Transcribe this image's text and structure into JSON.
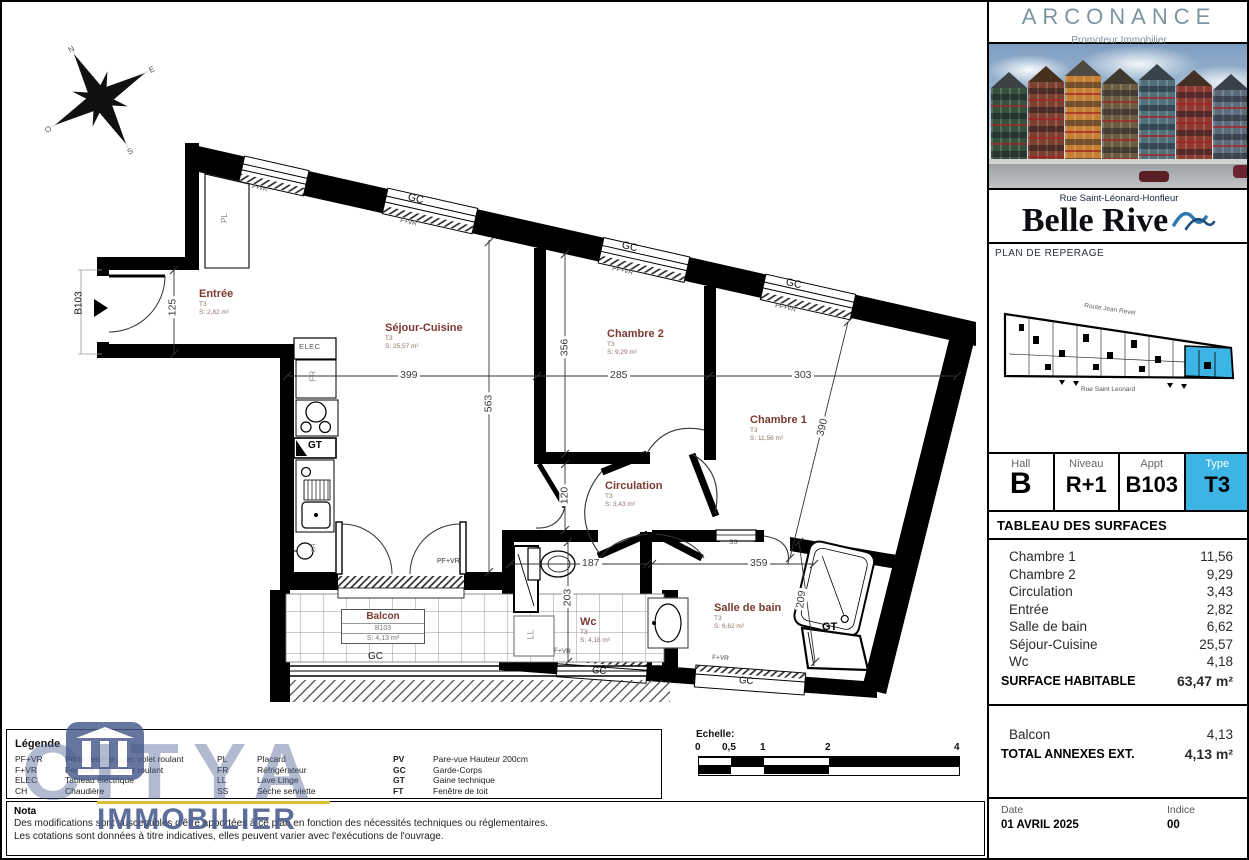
{
  "colors": {
    "accent": "#3cb4e5",
    "room_label": "#7b3a31",
    "brand": "#7b94a1",
    "watermark": "#485a8c"
  },
  "sidebar": {
    "brand": {
      "name": "ARCONANCE",
      "tagline": "Promoteur Immobilier"
    },
    "project": {
      "street": "Rue Saint-Léonard-Honfleur",
      "name": "Belle Rive"
    },
    "reperage": {
      "title": "PLAN DE REPERAGE",
      "street_top": "Route Jean Revel",
      "street_bottom": "Rue Saint Leonard"
    },
    "unit": {
      "hall_label": "Hall",
      "hall_value": "B",
      "niveau_label": "Niveau",
      "niveau_value": "R+1",
      "appt_label": "Appt",
      "appt_value": "B103",
      "type_label": "Type",
      "type_value": "T3"
    },
    "surfaces": {
      "title": "TABLEAU DES SURFACES",
      "rows": [
        {
          "label": "Chambre 1",
          "value": "11,56"
        },
        {
          "label": "Chambre 2",
          "value": "9,29"
        },
        {
          "label": "Circulation",
          "value": "3,43"
        },
        {
          "label": "Entrée",
          "value": "2,82"
        },
        {
          "label": "Salle de bain",
          "value": "6,62"
        },
        {
          "label": "Séjour-Cuisine",
          "value": "25,57"
        },
        {
          "label": "Wc",
          "value": "4,18"
        }
      ],
      "total_label": "SURFACE HABITABLE",
      "total_value": "63,47 m²",
      "annex_rows": [
        {
          "label": "Balcon",
          "value": "4,13"
        }
      ],
      "annex_total_label": "TOTAL ANNEXES EXT.",
      "annex_total_value": "4,13 m²"
    },
    "meta": {
      "date_label": "Date",
      "date_value": "01 AVRIL 2025",
      "indice_label": "Indice",
      "indice_value": "00"
    }
  },
  "plan": {
    "entry_ref": "B103",
    "rooms": {
      "entree": {
        "name": "Entrée",
        "type": "T3",
        "area": "S: 2,82 m²"
      },
      "sejour": {
        "name": "Séjour-Cuisine",
        "type": "T3",
        "area": "S: 25,57 m²"
      },
      "chambre2": {
        "name": "Chambre 2",
        "type": "T3",
        "area": "S: 9,29 m²"
      },
      "chambre1": {
        "name": "Chambre 1",
        "type": "T3",
        "area": "S: 11,56 m²"
      },
      "circulation": {
        "name": "Circulation",
        "type": "T3",
        "area": "S: 3,43 m²"
      },
      "wc": {
        "name": "Wc",
        "type": "T3",
        "area": "S: 4,18 m²"
      },
      "sdb": {
        "name": "Salle de bain",
        "type": "T3",
        "area": "S: 6,62 m²"
      },
      "balcon": {
        "name": "Balcon",
        "ref": "B103",
        "area": "S: 4,13 m²"
      }
    },
    "dims": {
      "d125": "125",
      "d399": "399",
      "d563": "563",
      "d356": "356",
      "d285": "285",
      "d303": "303",
      "d390": "390",
      "d120": "120",
      "d187": "187",
      "d203": "203",
      "d359": "359",
      "d209": "209"
    },
    "labels": {
      "gc": "GC",
      "pfvr": "PF+VR",
      "fvr": "F+VR",
      "elec": "ELEC",
      "fr": "FR",
      "gt": "GT",
      "ll": "LL",
      "ss": "SS",
      "pl": "PL",
      "ch": "CH"
    },
    "compass": {
      "n": "N",
      "e": "E",
      "s": "S",
      "o": "O"
    }
  },
  "legend": {
    "title": "Légende",
    "col1": [
      {
        "abbr": "PF+VR",
        "label": "Porte-fenêtre avec volet roulant"
      },
      {
        "abbr": "F+VR",
        "label": "Fenêtre avec volet roulant"
      },
      {
        "abbr": "ELEC",
        "label": "Tableau électrique"
      },
      {
        "abbr": "CH",
        "label": "Chaudière"
      }
    ],
    "col2": [
      {
        "abbr": "PL",
        "label": "Placard"
      },
      {
        "abbr": "FR",
        "label": "Réfrigérateur"
      },
      {
        "abbr": "LL",
        "label": "Lave Linge"
      },
      {
        "abbr": "SS",
        "label": "Sèche serviette"
      }
    ],
    "col3": [
      {
        "abbr": "PV",
        "label": "Pare-vue Hauteur 200cm"
      },
      {
        "abbr": "GC",
        "label": "Garde-Corps"
      },
      {
        "abbr": "GT",
        "label": "Gaine technique"
      },
      {
        "abbr": "FT",
        "label": "Fenêtre de toit"
      }
    ]
  },
  "nota": {
    "title": "Nota",
    "lines": [
      "Des modifications sont susceptibles d'être apportées à ce plan en fonction des nécessités techniques ou réglementaires.",
      "Les cotations sont données à titre indicatives, elles peuvent varier avec l'exécutions de l'ouvrage."
    ]
  },
  "scalebar": {
    "title": "Echelle:",
    "ticks": [
      "0",
      "0,5",
      "1",
      "2",
      "4"
    ]
  },
  "watermark": {
    "line1": "CITYA",
    "line2": "IMMOBILIER"
  }
}
